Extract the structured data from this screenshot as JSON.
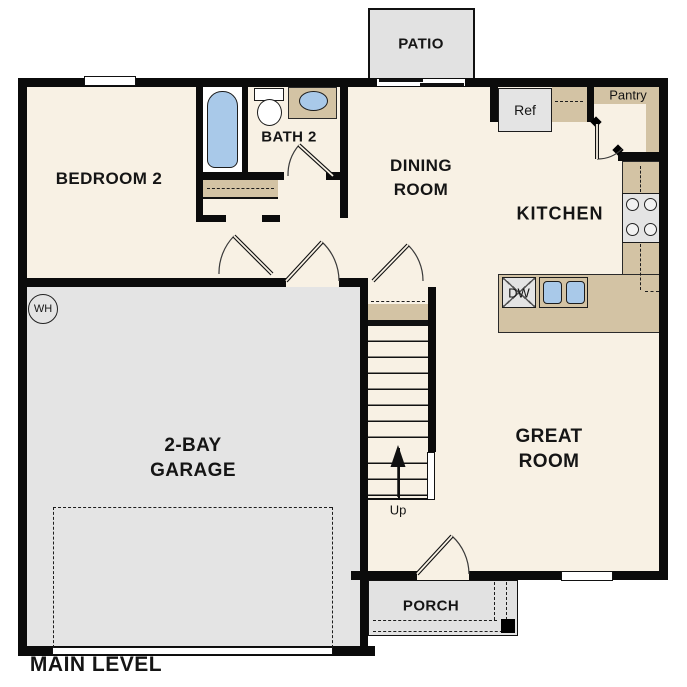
{
  "plan": {
    "title": "MAIN LEVEL",
    "labels": {
      "patio": "PATIO",
      "bedroom2": "BEDROOM 2",
      "bath2": "BATH 2",
      "dining1": "DINING",
      "dining2": "ROOM",
      "kitchen": "KITCHEN",
      "great1": "GREAT",
      "great2": "ROOM",
      "garage1": "2-BAY",
      "garage2": "GARAGE",
      "porch": "PORCH",
      "ref": "Ref",
      "pantry": "Pantry",
      "dw": "DW",
      "wh": "WH",
      "up": "Up"
    },
    "colors": {
      "floor": "#f8f1e4",
      "garage": "#e4e4e4",
      "counter": "#d3c3a4",
      "fixture-blue": "#a9c9e9",
      "wall": "#0b0b0b"
    }
  }
}
